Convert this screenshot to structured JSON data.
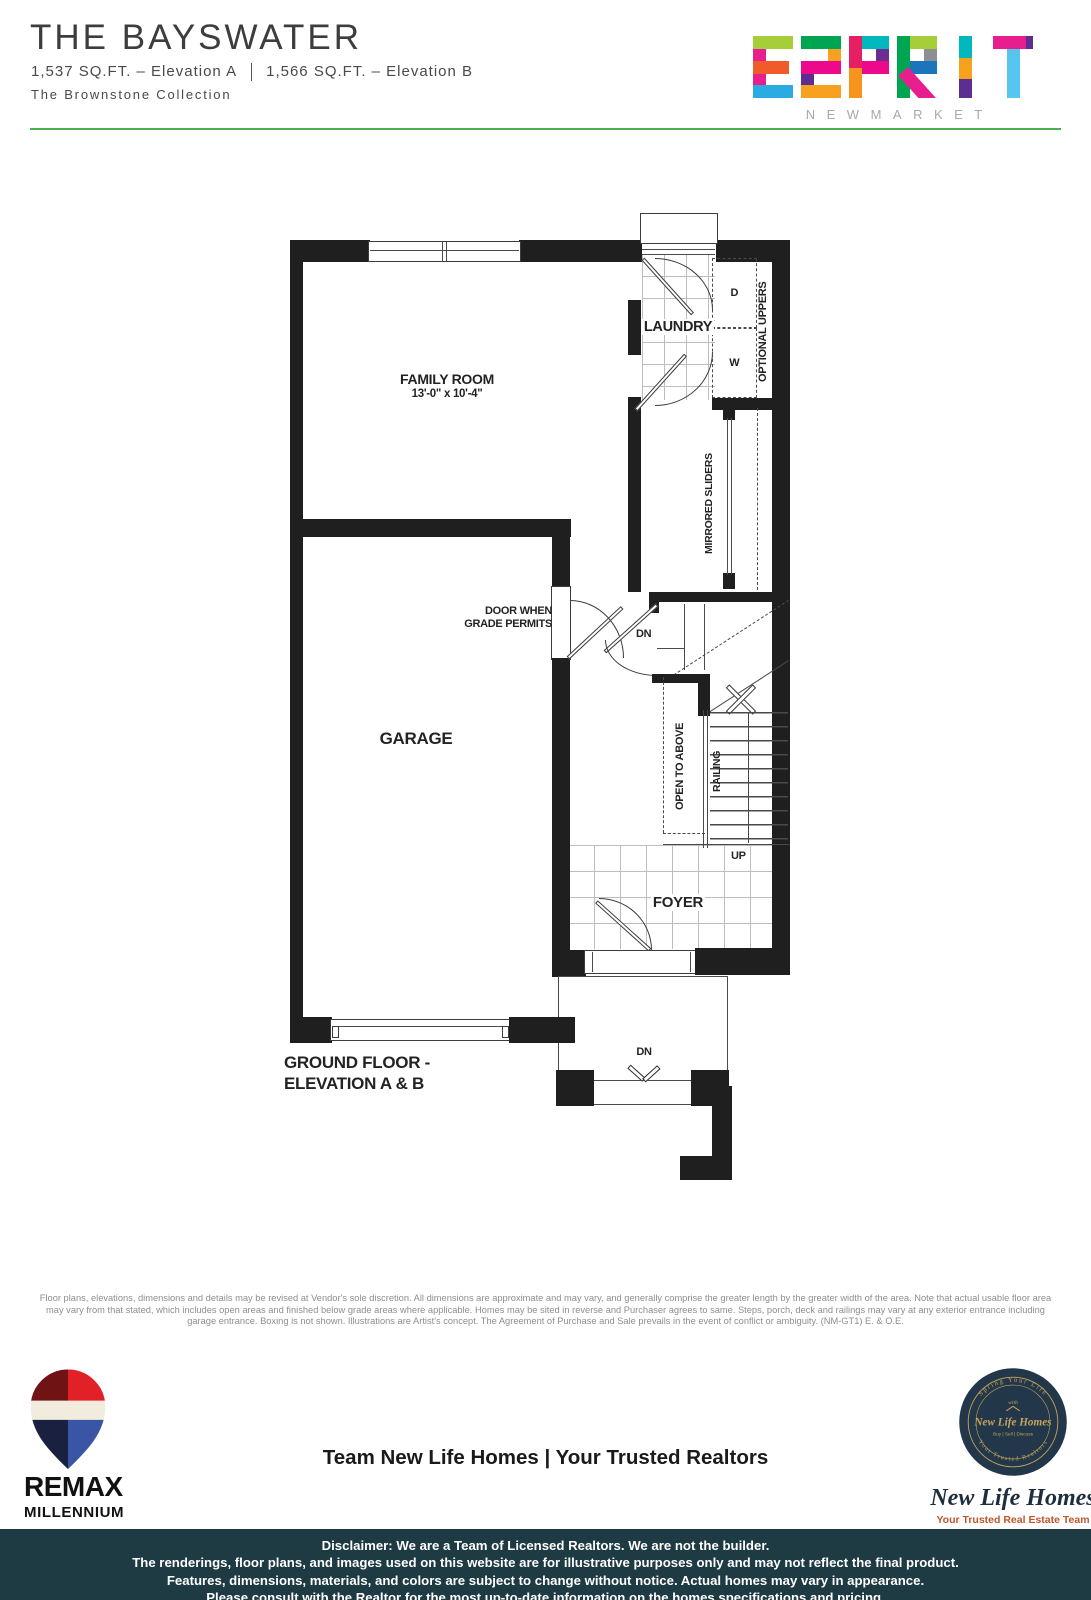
{
  "header": {
    "title": "THE BAYSWATER",
    "spec_a": "1,537 SQ.FT. – Elevation A",
    "spec_b": "1,566 SQ.FT. – Elevation B",
    "collection": "The Brownstone Collection"
  },
  "brand": {
    "name": "ESPRIT",
    "city": "NEWMARKET"
  },
  "plan": {
    "family_room_name": "FAMILY ROOM",
    "family_room_dims": "13'-0\" x 10'-4\"",
    "laundry": "LAUNDRY",
    "garage": "GARAGE",
    "foyer": "FOYER",
    "labels": {
      "d": "D",
      "w": "W",
      "optional_uppers": "OPTIONAL UPPERS",
      "mirrored_sliders": "MIRRORED SLIDERS",
      "door_when_1": "DOOR WHEN",
      "door_when_2": "GRADE PERMITS",
      "dn_stairs": "DN",
      "open_to_above": "OPEN TO ABOVE",
      "railing": "RAILING",
      "up": "UP",
      "dn_porch": "DN"
    },
    "caption_line1": "GROUND FLOOR -",
    "caption_line2": "ELEVATION A & B"
  },
  "legal": {
    "line1": "Floor plans, elevations, dimensions and details may be revised at Vendor's sole discretion.  All dimensions are approximate and may vary, and generally comprise the greater length by the greater width of the area.  Note that actual usable floor area",
    "line2": "may vary from that stated, which includes open areas and finished below grade areas where applicable.  Homes may be sited in reverse and Purchaser agrees to same.  Steps, porch, deck and railings  may vary at any exterior entrance including",
    "line3": "garage entrance.  Boxing is not shown.  Illustrations are Artist's concept.  The Agreement of Purchase and Sale prevails in the event of conflict or ambiguity. (NM-GT1) E. & O.E."
  },
  "footer": {
    "remax_brand": "REMAX",
    "remax_sub": "MILLENNIUM",
    "team": "Team New Life Homes | Your Trusted Realtors",
    "newlife": {
      "badge_arc_top": "Spring Your Life",
      "badge_with": "with",
      "badge_name": "New Life Homes",
      "badge_services": "Buy | Sell | Discuss",
      "badge_arc_bottom": "Your Trusted Realtors",
      "script_name": "New Life Homes",
      "tagline": "Your Trusted Real Estate Team"
    },
    "disclaimer": [
      "Disclaimer: We are a Team of Licensed Realtors. We are not the builder.",
      "The renderings, floor plans, and images used on this website are for illustrative purposes only and may not reflect the final product.",
      "Features, dimensions, materials, and colors are subject to change without notice. Actual homes may vary in appearance.",
      "Please consult with the Realtor for the most up-to-date information on the homes specifications and pricing."
    ]
  },
  "colors": {
    "rule_green": "#4caf50",
    "wall": "#1f1f1f",
    "footer_bg": "#1e3a43",
    "nlh_gold": "#c9a35c",
    "nlh_navy": "#22384a",
    "tagline_orange": "#c0552b"
  }
}
